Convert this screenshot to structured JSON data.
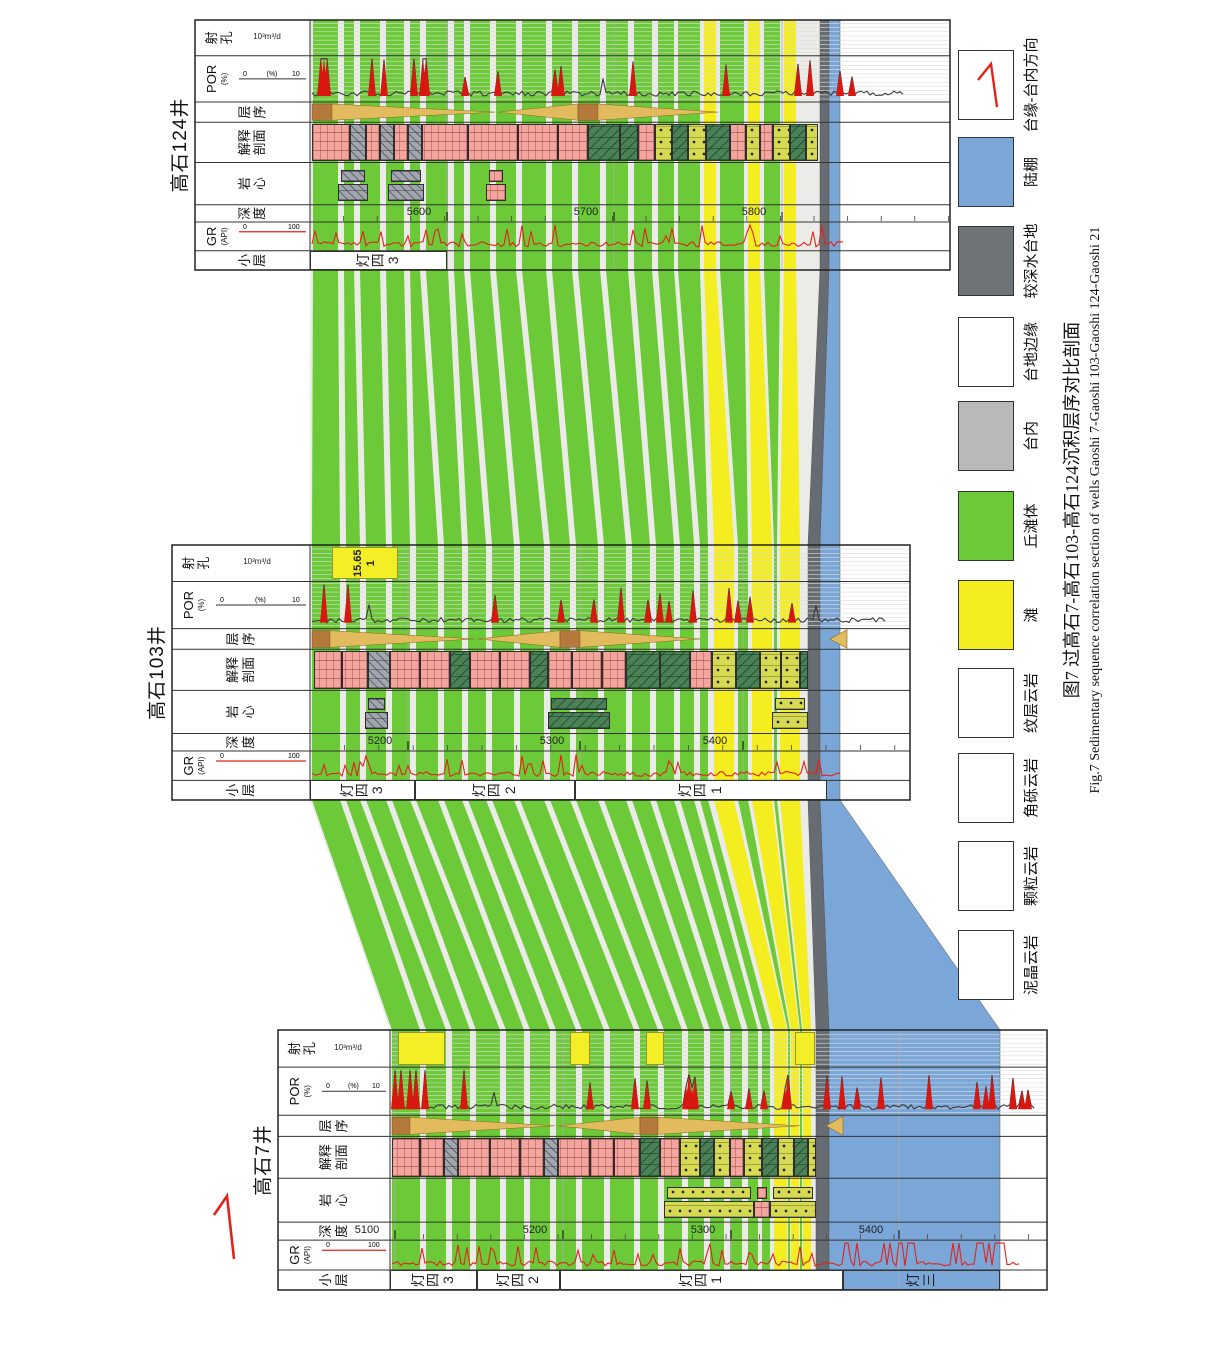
{
  "figure": {
    "caption_zh": "图7  过高石7-高石103-高石124沉积层序对比剖面",
    "caption_en": "Fig.7  Sedimentary sequence correlation section of wells Gaoshi 7-Gaoshi 103-Gaoshi 124-Gaoshi 21",
    "direction_arrow_label": "1"
  },
  "track_headers": [
    {
      "key": "xiaoceng",
      "zh": "小层"
    },
    {
      "key": "gr",
      "zh": "GR",
      "sub": "(API)",
      "s0": "0",
      "s1": "100",
      "line": "red"
    },
    {
      "key": "shendu",
      "zh": "深度"
    },
    {
      "key": "yanxin",
      "zh": "岩心"
    },
    {
      "key": "jieshi",
      "zh": "解释剖面"
    },
    {
      "key": "cengxu",
      "zh": "层序"
    },
    {
      "key": "por",
      "zh": "POR",
      "sub": "(%)",
      "s0": "0",
      "s1": "10",
      "line": "dark"
    },
    {
      "key": "shekong",
      "zh": "射孔",
      "unit": "10³m³/d"
    }
  ],
  "col_ratios": [
    0.077,
    0.115,
    0.069,
    0.169,
    0.161,
    0.081,
    0.185,
    0.143
  ],
  "wells": [
    {
      "id": "w7",
      "name": "高石7井",
      "x": 59,
      "w": 260,
      "top": 278,
      "data_top": 390,
      "bottom": 1047,
      "depth_labels": [
        {
          "v": "5100",
          "y": 395
        },
        {
          "v": "5200",
          "y": 563
        },
        {
          "v": "5300",
          "y": 731
        },
        {
          "v": "5400",
          "y": 899
        }
      ],
      "minor_tick": 33.6,
      "layers": [
        {
          "label": "灯四3",
          "y0": 390,
          "y1": 477,
          "fill": "white"
        },
        {
          "label": "灯四2",
          "y0": 477,
          "y1": 560,
          "fill": "white"
        },
        {
          "label": "灯四1",
          "y0": 560,
          "y1": 843,
          "fill": "white"
        },
        {
          "label": "灯三",
          "y0": 843,
          "y1": 1000,
          "fill": "none"
        }
      ],
      "lith": [
        [
          392,
          420,
          "p"
        ],
        [
          420,
          444,
          "p"
        ],
        [
          444,
          458,
          "b"
        ],
        [
          458,
          490,
          "p"
        ],
        [
          490,
          520,
          "p"
        ],
        [
          520,
          544,
          "p"
        ],
        [
          544,
          558,
          "b"
        ],
        [
          558,
          590,
          "p"
        ],
        [
          590,
          614,
          "p"
        ],
        [
          614,
          640,
          "p"
        ],
        [
          640,
          660,
          "m"
        ],
        [
          660,
          680,
          "p"
        ],
        [
          680,
          700,
          "g"
        ],
        [
          700,
          714,
          "m"
        ],
        [
          714,
          730,
          "g"
        ],
        [
          730,
          744,
          "p"
        ],
        [
          744,
          762,
          "g"
        ],
        [
          762,
          778,
          "m"
        ],
        [
          778,
          794,
          "g"
        ],
        [
          794,
          808,
          "m"
        ],
        [
          808,
          816,
          "g"
        ]
      ],
      "cores": [
        [
          664,
          754,
          "g"
        ],
        [
          754,
          770,
          "p"
        ],
        [
          770,
          816,
          "g"
        ]
      ],
      "perforations": [
        {
          "y0": 398,
          "y1": 445
        },
        {
          "y0": 570,
          "y1": 590
        },
        {
          "y0": 646,
          "y1": 664
        },
        {
          "y0": 795,
          "y1": 815
        }
      ],
      "sequence": {
        "rect1": [
          392,
          410
        ],
        "tri1": [
          410,
          555
        ],
        "tri2": [
          558,
          640
        ],
        "rect2": [
          640,
          658
        ],
        "tri3": [
          658,
          800
        ],
        "arrow": [
          826,
          843
        ]
      },
      "gr_end": 1020,
      "por_end": 1035,
      "gr_hot": [
        832,
        1015
      ],
      "por_hot": [
        392,
        470
      ],
      "seed": 11
    },
    {
      "id": "w103",
      "name": "高石103井",
      "x": 549,
      "w": 255,
      "top": 172,
      "data_top": 310,
      "bottom": 910,
      "depth_labels": [
        {
          "v": "5200",
          "y": 408
        },
        {
          "v": "5300",
          "y": 580
        },
        {
          "v": "5400",
          "y": 743
        }
      ],
      "minor_tick": 34.4,
      "layers": [
        {
          "label": "灯四3",
          "y0": 310,
          "y1": 415,
          "fill": "white"
        },
        {
          "label": "灯四2",
          "y0": 415,
          "y1": 575,
          "fill": "white"
        },
        {
          "label": "灯四1",
          "y0": 575,
          "y1": 827,
          "fill": "white"
        }
      ],
      "lith": [
        [
          314,
          342,
          "p"
        ],
        [
          342,
          368,
          "p"
        ],
        [
          368,
          390,
          "b"
        ],
        [
          390,
          420,
          "p"
        ],
        [
          420,
          450,
          "p"
        ],
        [
          450,
          470,
          "m"
        ],
        [
          470,
          500,
          "p"
        ],
        [
          500,
          530,
          "p"
        ],
        [
          530,
          548,
          "m"
        ],
        [
          548,
          572,
          "p"
        ],
        [
          572,
          602,
          "p"
        ],
        [
          602,
          626,
          "p"
        ],
        [
          626,
          660,
          "m"
        ],
        [
          660,
          690,
          "m"
        ],
        [
          690,
          712,
          "p"
        ],
        [
          712,
          736,
          "g"
        ],
        [
          736,
          760,
          "m"
        ],
        [
          760,
          781,
          "g"
        ],
        [
          781,
          800,
          "g"
        ],
        [
          800,
          808,
          "m"
        ]
      ],
      "cores": [
        [
          365,
          388,
          "b"
        ],
        [
          548,
          610,
          "m"
        ],
        [
          772,
          808,
          "g"
        ]
      ],
      "perforations": [
        {
          "y0": 332,
          "y1": 398,
          "label": "15.65",
          "sub": "1"
        }
      ],
      "sequence": {
        "rect1": [
          312,
          330
        ],
        "tri1": [
          330,
          475
        ],
        "tri2": [
          478,
          560
        ],
        "rect2": [
          560,
          580
        ],
        "tri3": [
          580,
          700
        ],
        "arrow": [
          830,
          847
        ]
      },
      "gr_end": 840,
      "por_end": 885,
      "gr_hot": null,
      "por_hot": [
        315,
        365
      ],
      "seed": 22
    },
    {
      "id": "w124",
      "name": "高石124井",
      "x": 1079,
      "w": 250,
      "top": 195,
      "data_top": 310,
      "bottom": 950,
      "depth_labels": [
        {
          "v": "5600",
          "y": 447
        },
        {
          "v": "5700",
          "y": 614
        },
        {
          "v": "5800",
          "y": 782
        }
      ],
      "minor_tick": 33.6,
      "layers": [
        {
          "label": "灯四3",
          "y0": 310,
          "y1": 447,
          "fill": "white"
        }
      ],
      "lith": [
        [
          312,
          350,
          "p"
        ],
        [
          350,
          366,
          "b"
        ],
        [
          366,
          380,
          "p"
        ],
        [
          380,
          394,
          "b"
        ],
        [
          394,
          408,
          "p"
        ],
        [
          408,
          422,
          "b"
        ],
        [
          422,
          468,
          "p"
        ],
        [
          468,
          518,
          "p"
        ],
        [
          518,
          558,
          "p"
        ],
        [
          558,
          588,
          "p"
        ],
        [
          588,
          620,
          "m"
        ],
        [
          620,
          638,
          "m"
        ],
        [
          638,
          655,
          "p"
        ],
        [
          655,
          672,
          "g"
        ],
        [
          672,
          688,
          "m"
        ],
        [
          688,
          706,
          "g"
        ],
        [
          706,
          730,
          "m"
        ],
        [
          730,
          746,
          "p"
        ],
        [
          746,
          760,
          "g"
        ],
        [
          760,
          773,
          "p"
        ],
        [
          773,
          790,
          "g"
        ],
        [
          790,
          806,
          "m"
        ],
        [
          806,
          818,
          "g"
        ]
      ],
      "cores": [
        [
          338,
          368,
          "b"
        ],
        [
          388,
          424,
          "b"
        ],
        [
          486,
          506,
          "p"
        ]
      ],
      "perforations": [],
      "sequence": {
        "rect1": [
          312,
          332
        ],
        "tri1": [
          332,
          495
        ],
        "tri2": [
          498,
          578
        ],
        "rect2": [
          578,
          598
        ],
        "tri3": [
          598,
          718
        ],
        "arrow": null
      },
      "gr_end": 845,
      "por_end": 905,
      "gr_hot": null,
      "por_hot": [
        312,
        430
      ],
      "seed": 33
    }
  ],
  "bands": [
    {
      "c": "base",
      "s": [
        [
          390,
          1000
        ],
        [
          310,
          840
        ],
        [
          310,
          840
        ]
      ]
    },
    {
      "c": "g",
      "s": [
        [
          392,
          420
        ],
        [
          312,
          340
        ],
        [
          313,
          338
        ]
      ]
    },
    {
      "c": "g",
      "s": [
        [
          426,
          446
        ],
        [
          346,
          360
        ],
        [
          344,
          354
        ]
      ]
    },
    {
      "c": "g",
      "s": [
        [
          452,
          470
        ],
        [
          366,
          386
        ],
        [
          360,
          380
        ]
      ]
    },
    {
      "c": "g",
      "s": [
        [
          476,
          500
        ],
        [
          392,
          410
        ],
        [
          386,
          404
        ]
      ]
    },
    {
      "c": "g",
      "s": [
        [
          506,
          524
        ],
        [
          416,
          438
        ],
        [
          410,
          420
        ]
      ]
    },
    {
      "c": "g",
      "s": [
        [
          530,
          550
        ],
        [
          444,
          462
        ],
        [
          426,
          448
        ]
      ]
    },
    {
      "c": "g",
      "s": [
        [
          556,
          576
        ],
        [
          468,
          486
        ],
        [
          454,
          464
        ]
      ]
    },
    {
      "c": "g",
      "s": [
        [
          582,
          604
        ],
        [
          492,
          514
        ],
        [
          470,
          490
        ]
      ]
    },
    {
      "c": "g",
      "s": [
        [
          610,
          634
        ],
        [
          520,
          544
        ],
        [
          496,
          516
        ]
      ]
    },
    {
      "c": "g",
      "s": [
        [
          640,
          658
        ],
        [
          550,
          570
        ],
        [
          522,
          546
        ]
      ]
    },
    {
      "c": "g",
      "s": [
        [
          664,
          682
        ],
        [
          576,
          598
        ],
        [
          552,
          572
        ]
      ]
    },
    {
      "c": "g",
      "s": [
        [
          688,
          704
        ],
        [
          604,
          626
        ],
        [
          578,
          600
        ]
      ]
    },
    {
      "c": "g",
      "s": [
        [
          710,
          724
        ],
        [
          632,
          650
        ],
        [
          606,
          628
        ]
      ]
    },
    {
      "c": "g",
      "s": [
        [
          730,
          742
        ],
        [
          656,
          674
        ],
        [
          634,
          652
        ]
      ]
    },
    {
      "c": "g",
      "s": [
        [
          748,
          758
        ],
        [
          680,
          694
        ],
        [
          658,
          674
        ]
      ]
    },
    {
      "c": "g",
      "s": [
        [
          762,
          770
        ],
        [
          700,
          708
        ],
        [
          678,
          700
        ]
      ]
    },
    {
      "c": "y",
      "s": [
        [
          774,
          787
        ],
        [
          714,
          734
        ],
        [
          704,
          716
        ]
      ]
    },
    {
      "c": "g",
      "s": [
        [
          788,
          790
        ],
        [
          738,
          748
        ],
        [
          720,
          744
        ]
      ]
    },
    {
      "c": "y",
      "s": [
        [
          791,
          799
        ],
        [
          752,
          772
        ],
        [
          748,
          760
        ]
      ]
    },
    {
      "c": "g",
      "s": [
        [
          800,
          802
        ],
        [
          774,
          777
        ],
        [
          764,
          780
        ]
      ]
    },
    {
      "c": "y",
      "s": [
        [
          803,
          811
        ],
        [
          780,
          800
        ],
        [
          784,
          796
        ]
      ]
    },
    {
      "c": "gray",
      "s": [
        [
          816,
          829
        ],
        [
          808,
          820
        ],
        [
          820,
          829
        ]
      ]
    },
    {
      "c": "blue",
      "s": [
        [
          829,
          1000
        ],
        [
          820,
          840
        ],
        [
          829,
          840
        ]
      ]
    }
  ],
  "legend": {
    "items": [
      {
        "label": "泥晶云岩",
        "type": "micrite",
        "cx": 384
      },
      {
        "label": "颗粒云岩",
        "type": "grain",
        "cx": 473
      },
      {
        "label": "角砾云岩",
        "type": "breccia",
        "cx": 561
      },
      {
        "label": "纹层云岩",
        "type": "laminated",
        "cx": 646
      },
      {
        "label": "滩",
        "type": "yellow",
        "cx": 734
      },
      {
        "label": "丘滩体",
        "type": "green",
        "cx": 823
      },
      {
        "label": "台内",
        "type": "gray",
        "cx": 913
      },
      {
        "label": "台地边缘",
        "type": "white",
        "cx": 997
      },
      {
        "label": "较深水台地",
        "type": "darkgray",
        "cx": 1088
      },
      {
        "label": "陆棚",
        "type": "blue",
        "cx": 1177
      },
      {
        "label": "台缘-台内方向",
        "type": "arrow",
        "cx": 1264
      }
    ]
  },
  "colors": {
    "band_green": "#6cc937",
    "band_yellow": "#f4ee20",
    "band_base": "#ebebe8",
    "shelf_blue": "#7aa6d8",
    "deep_gray": "#676c72",
    "platform_gray": "#b9b9b9",
    "gr_red": "#e0241c",
    "por_line": "#3a3a3a",
    "por_red": "#d81710",
    "wedge_brown": "#b5793b",
    "wedge_tan": "#e2bb5e",
    "border": "#222",
    "grid": "#b0b0b0"
  }
}
